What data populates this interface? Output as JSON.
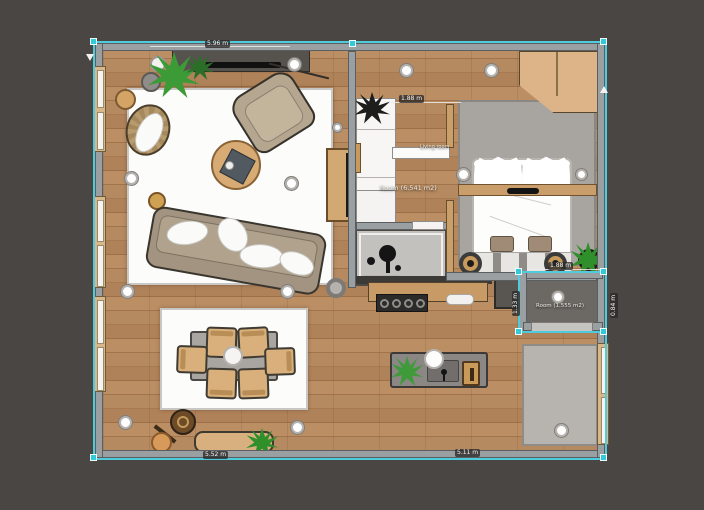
{
  "scene": {
    "type": "floor-plan-editor-canvas"
  },
  "room_labels": {
    "hall": "Room (6.541 m2)",
    "selected_room": "Room (1.555 m2)",
    "door": "Living room"
  },
  "dimensions": {
    "top_wall": "5.96 m",
    "hall_opening": "1.88 m",
    "bottom_left": "5.52 m",
    "bottom_right": "5.11 m",
    "selected_top": "1.88 m",
    "selected_left": "1.33 m",
    "selected_right": "0.84 m"
  },
  "colors": {
    "background": "#4a4643",
    "wall": "#9aa0a2",
    "floor_wood": "#b3855e",
    "selection_teal": "#4ecbdc",
    "rug_white": "#fcfcfb",
    "rug_gray": "#a8a5a1",
    "furniture_wood": "#d2a873",
    "plant_green": "#3f9b3a"
  }
}
